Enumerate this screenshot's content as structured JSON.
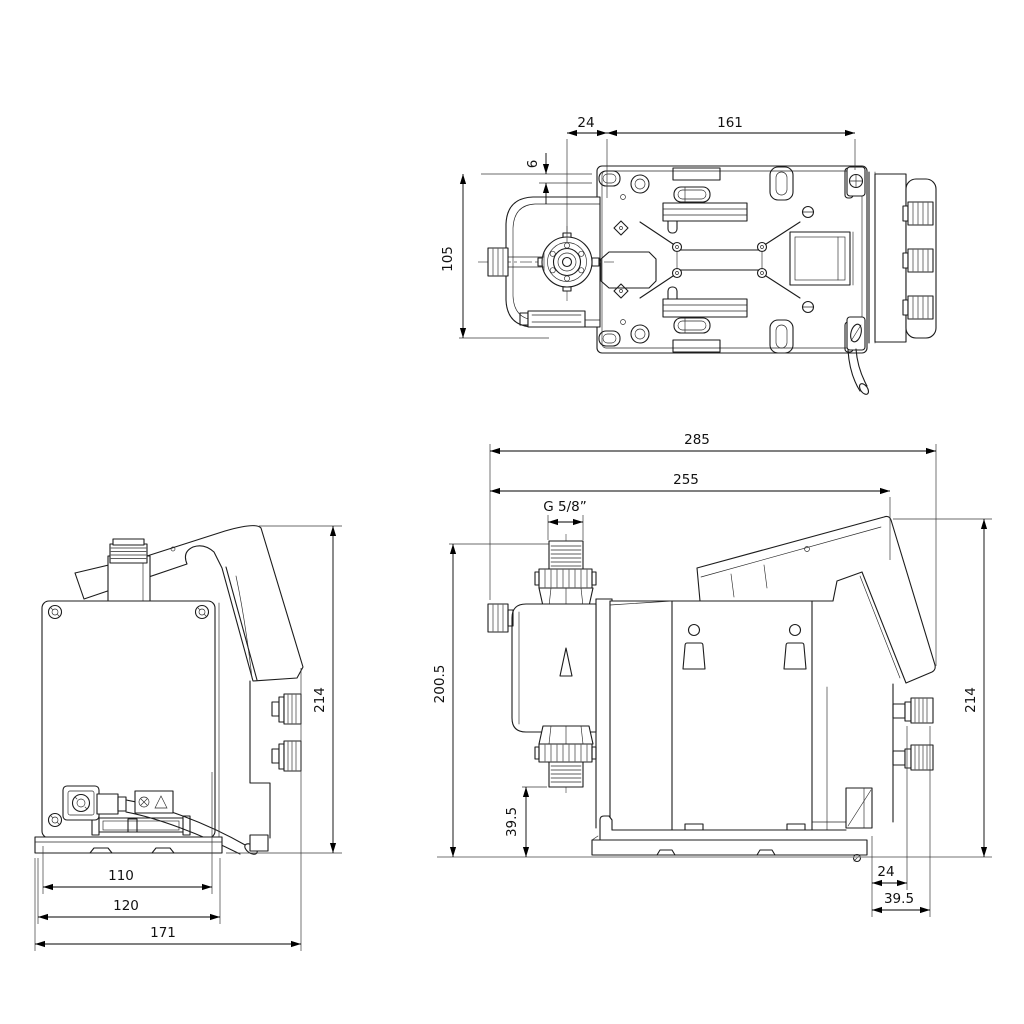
{
  "colors": {
    "line": "#1c1c1c",
    "dimension_line": "#000000",
    "background": "#ffffff"
  },
  "top_view": {
    "dim_labels": [
      "24",
      "161",
      "6",
      "105"
    ]
  },
  "rear_view": {
    "dim_labels": [
      "110",
      "120",
      "171",
      "214"
    ]
  },
  "side_view": {
    "dim_labels": [
      "285",
      "255",
      "G 5/8”",
      "200.5",
      "39.5",
      "214",
      "24",
      "39.5"
    ]
  }
}
